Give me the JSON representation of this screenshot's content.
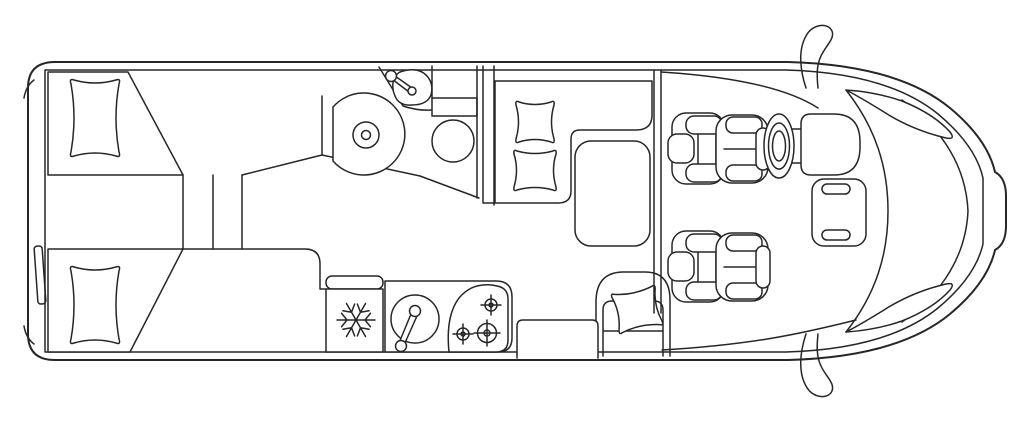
{
  "diagram": {
    "type": "motorhome-floorplan-top-view",
    "background_color": "#ffffff",
    "line_color": "#262626",
    "features": {
      "rear_bedroom": [
        "single-bed-top",
        "single-bed-bottom",
        "bed-pillows",
        "center-steps"
      ],
      "step_lines": 3,
      "bathroom": [
        "shower-tray",
        "washbasin",
        "basin-faucet",
        "toilet-cistern",
        "toilet-bowl"
      ],
      "wardrobe_partition": true,
      "dinette": [
        "l-shaped-bench",
        "seat-cushion-upper",
        "seat-cushion-lower",
        "dinette-table",
        "side-seat",
        "entry-step"
      ],
      "kitchen": [
        "refrigerator",
        "snowflake-symbol",
        "round-sink",
        "sink-faucet",
        "three-burner-hob"
      ],
      "hob_burners": 3,
      "cab": [
        "driver-seat",
        "steering-wheel",
        "passenger-seat",
        "dashboard-pod",
        "center-console",
        "windshield",
        "a-pillar-left",
        "a-pillar-right",
        "side-mirror-top",
        "side-mirror-bottom"
      ]
    }
  }
}
